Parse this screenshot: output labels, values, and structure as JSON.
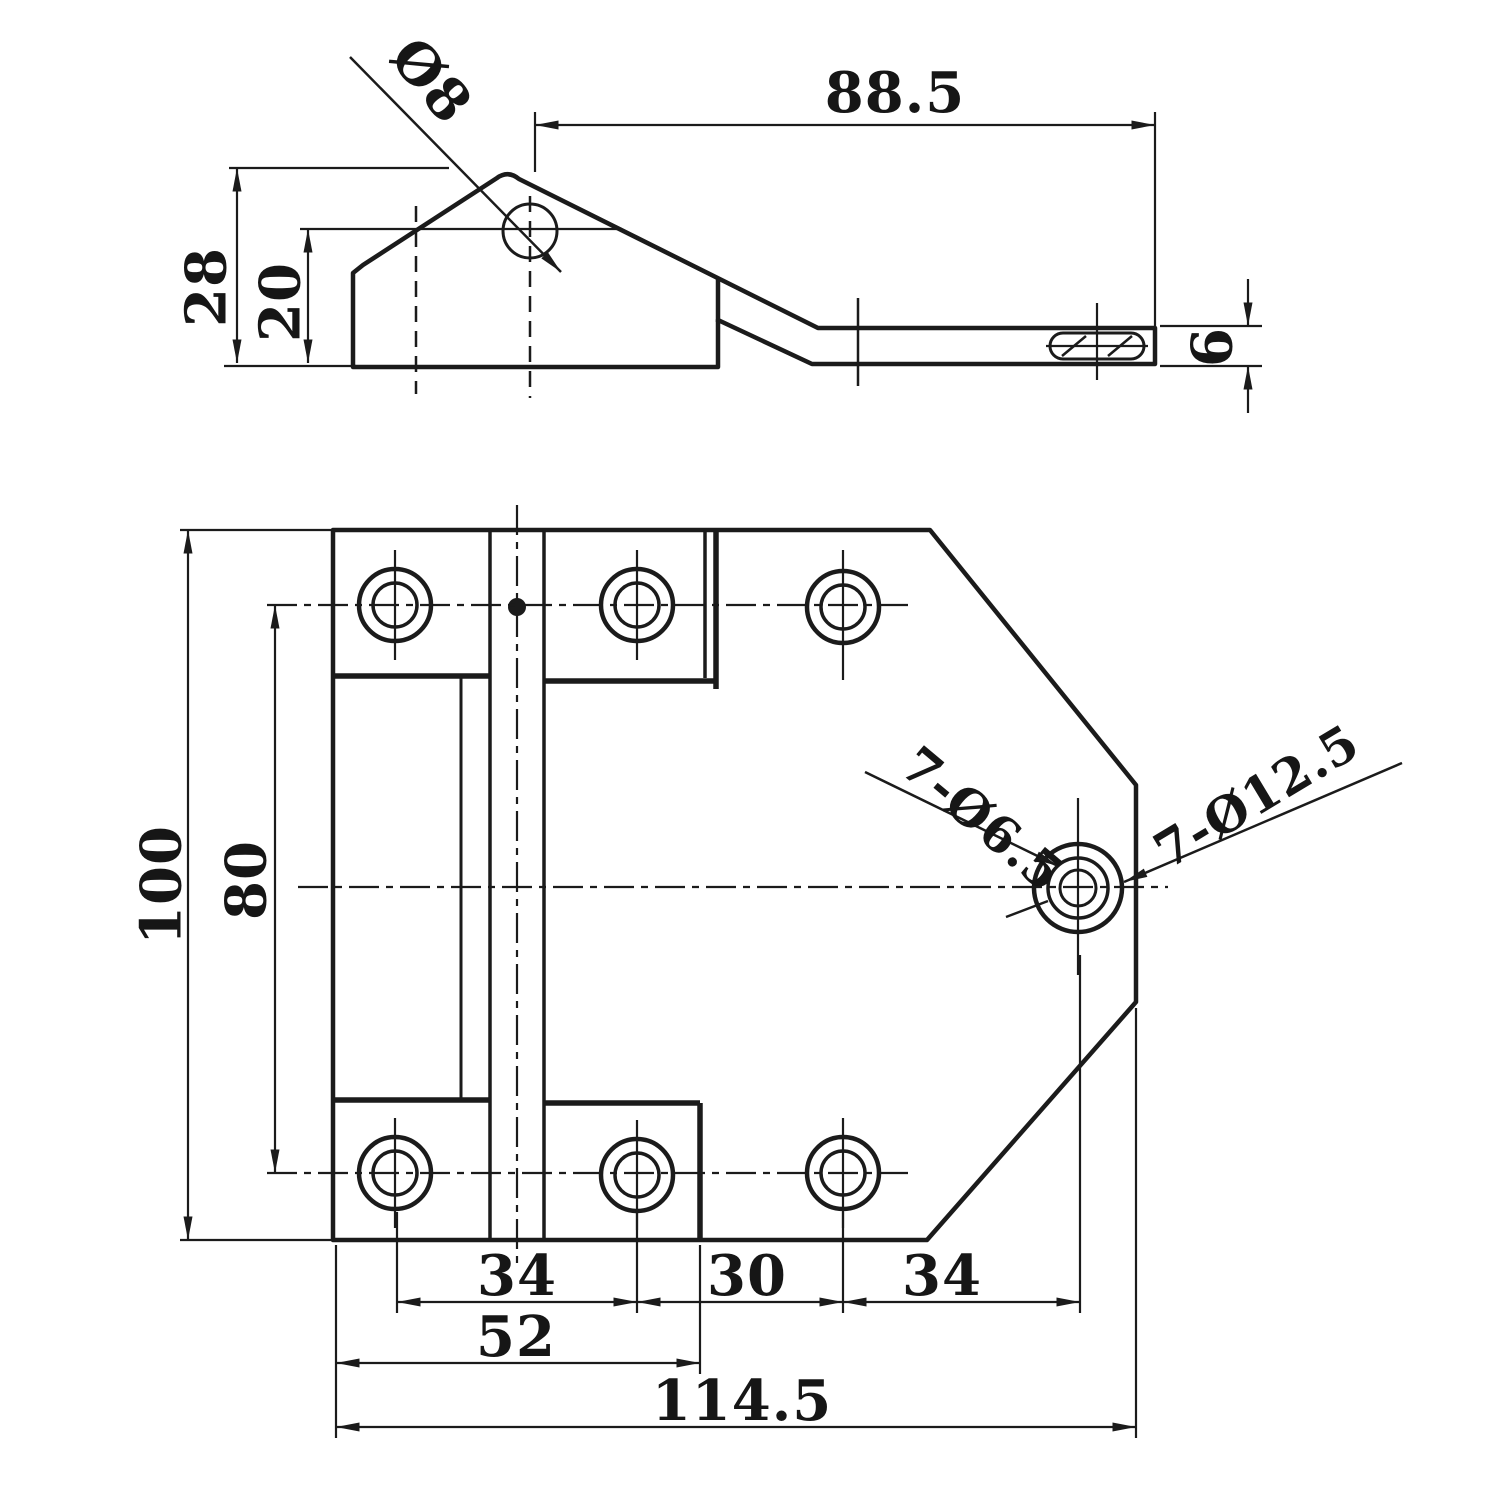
{
  "drawing": {
    "background": "#ffffff",
    "line_color": "#1b1b1b",
    "side_view": {
      "labels": {
        "hole_diameter": "Ø8",
        "length_to_end": "88.5",
        "total_height": "28",
        "hole_center_height": "20",
        "arm_thickness": "6"
      }
    },
    "plan_view": {
      "labels": {
        "plate_height": "100",
        "hole_row_spacing": "80",
        "hole_pitch_left": "34",
        "hole_pitch_middle": "30",
        "hole_pitch_right": "34",
        "left_section_width": "52",
        "overall_width": "114.5",
        "through_holes_callout": "7-Ø6.5",
        "counterbore_callout": "7-Ø12.5"
      }
    }
  }
}
